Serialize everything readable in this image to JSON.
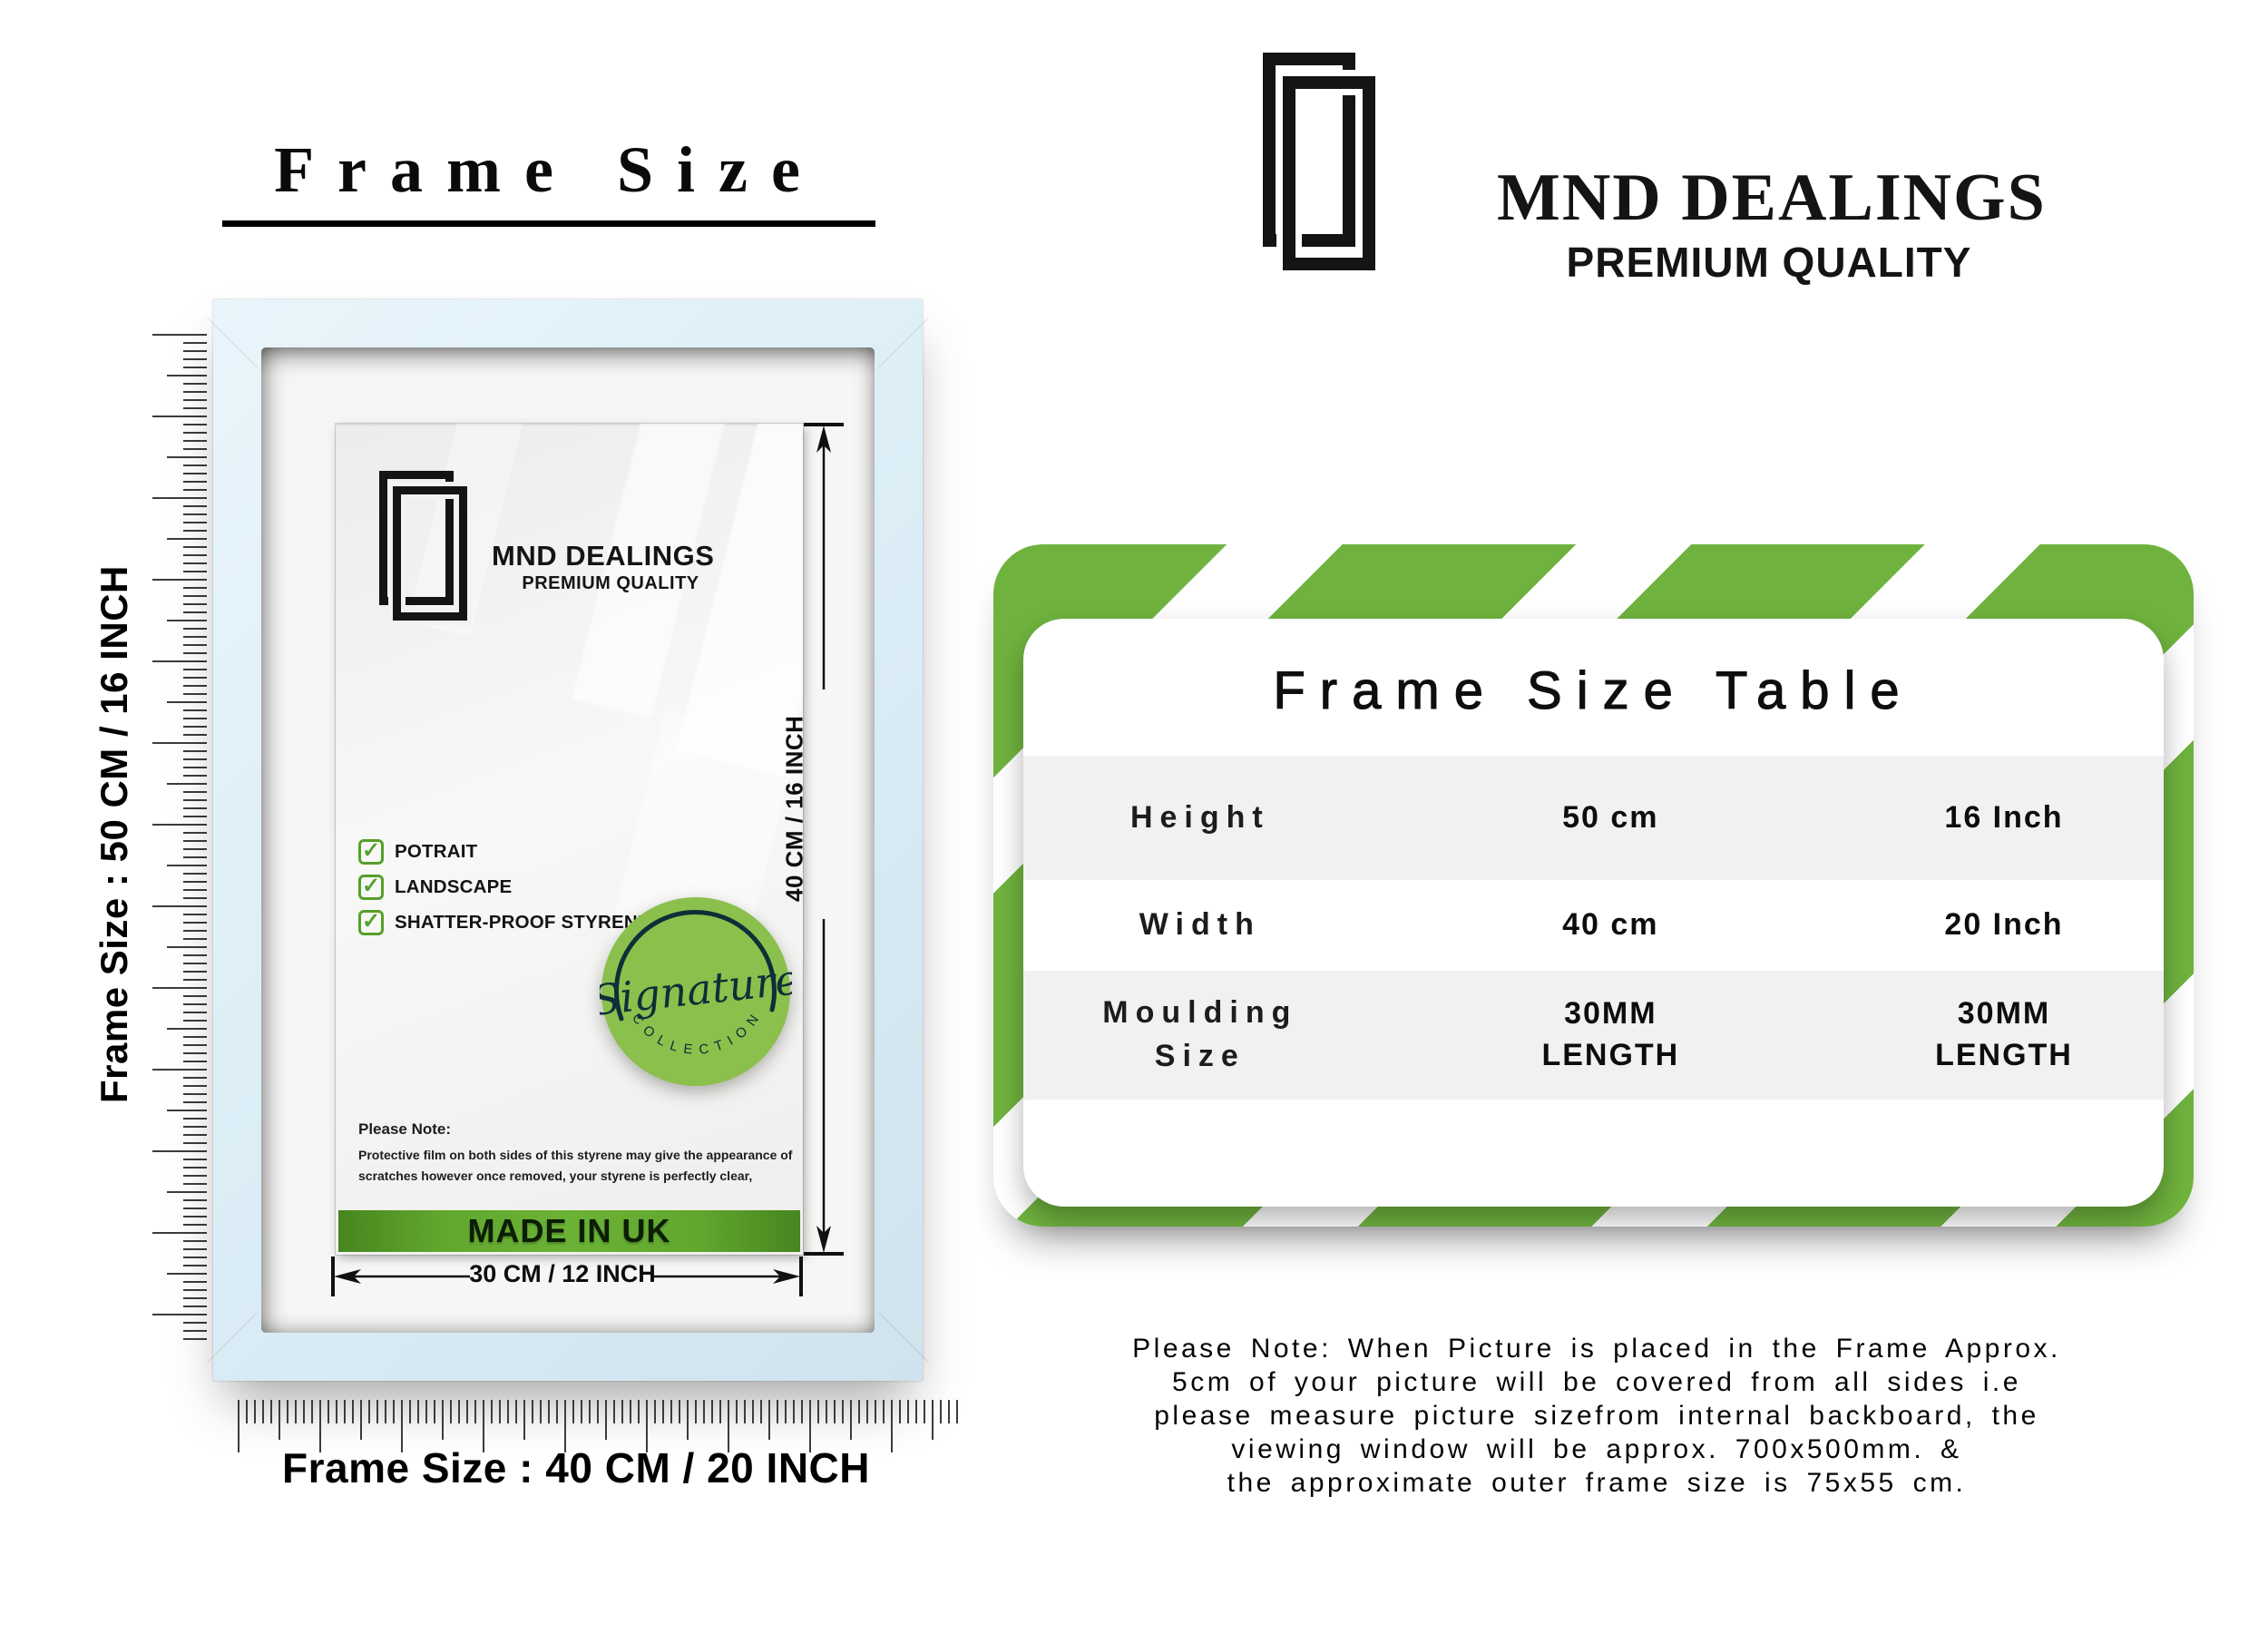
{
  "title": "Frame Size",
  "brand": {
    "name": "MND DEALINGS",
    "tagline": "PREMIUM QUALITY"
  },
  "frame_mock": {
    "logo_name": "MND DEALINGS",
    "logo_tagline": "PREMIUM QUALITY",
    "features": [
      "POTRAIT",
      "LANDSCAPE",
      "SHATTER-PROOF STYRENE"
    ],
    "check_glyph": "✓",
    "badge_script": "Signature",
    "badge_arc": "C O L L E C T I O N",
    "note_title": "Please Note:",
    "note_body": "Protective film on both sides of this styrene may give the appearance of scratches however once removed, your styrene is perfectly clear,",
    "made_in": "MADE IN UK",
    "dim_height": "40 CM / 16 INCH",
    "dim_width": "30 CM / 12 INCH",
    "ruler_left_label": "Frame Size : 50 CM / 16 INCH",
    "ruler_bottom_label": "Frame Size : 40 CM / 20 INCH"
  },
  "size_table": {
    "title": "Frame Size Table",
    "rows": [
      {
        "label": "Height",
        "cm": "50 cm",
        "inch": "16 Inch"
      },
      {
        "label": "Width",
        "cm": "40 cm",
        "inch": "20 Inch"
      },
      {
        "label": "Moulding Size",
        "cm": "30MM LENGTH",
        "inch": "30MM LENGTH"
      }
    ]
  },
  "footer_note_lines": [
    "Please Note: When Picture is placed in the Frame Approx.",
    "5cm of your picture will be covered from all sides i.e",
    "please measure picture sizefrom internal backboard, the",
    "viewing window will be approx. 700x500mm. &",
    "the approximate outer frame size is 75x55 cm."
  ],
  "colors": {
    "stripe_green": "#6fb33e",
    "badge_green": "#8bc04c",
    "check_green": "#55a02a",
    "frame_blue": "#ddeef7",
    "table_stripe_gray": "#f1f1f1",
    "made_in_dark": "#47851f",
    "made_in_light": "#6bb236"
  }
}
